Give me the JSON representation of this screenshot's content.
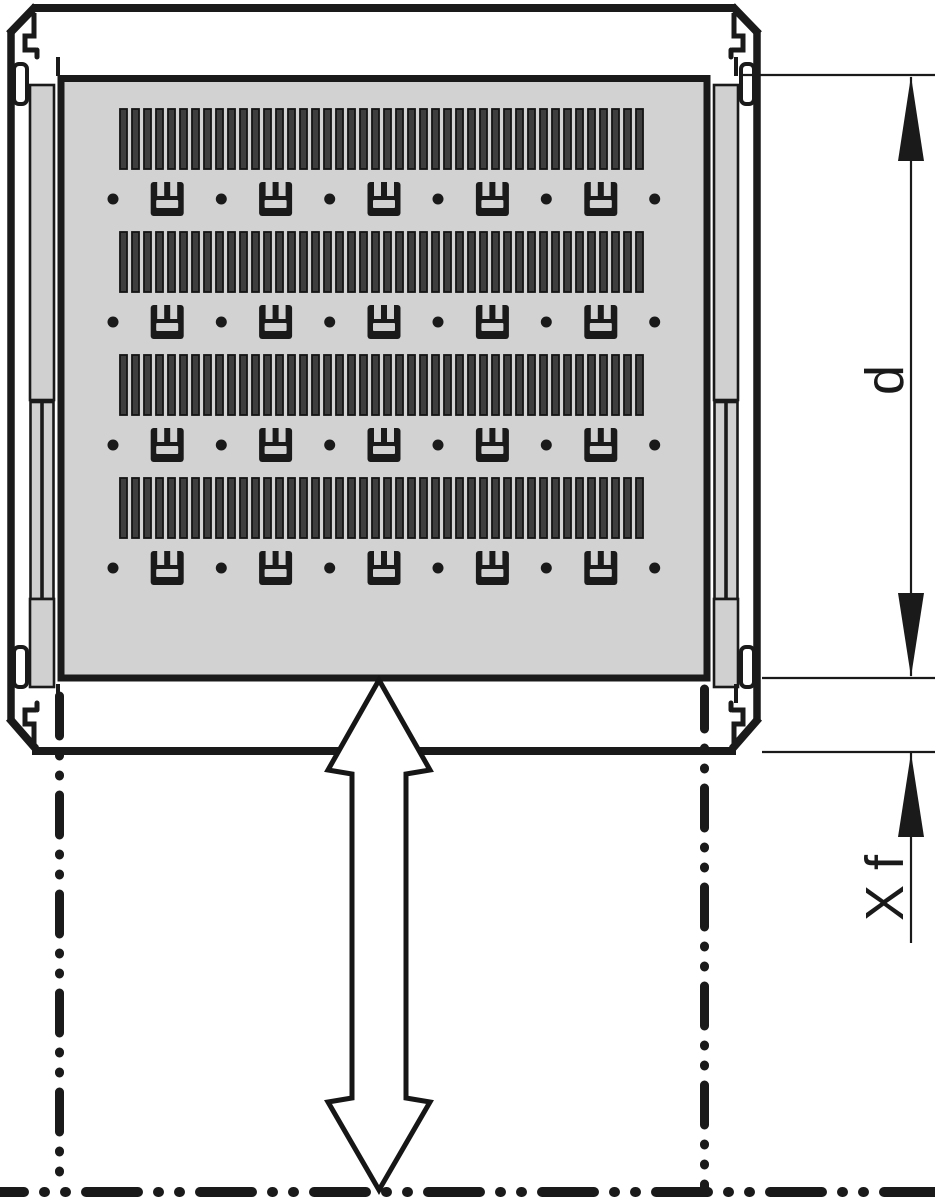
{
  "labels": {
    "d": "d",
    "xf": "X f"
  },
  "colors": {
    "line": "#1a1a1a",
    "panel": "#d2d2d2",
    "rail": "#d0d0d0",
    "slat_fill": "#3e3e3e",
    "slat_stroke": "#141414",
    "white": "#ffffff"
  },
  "diagram": {
    "slats": {
      "rows_y": [
        109,
        232,
        355,
        478
      ],
      "count": 44,
      "x_start": 120,
      "pitch": 12,
      "width": 7,
      "height": 60
    },
    "clips": {
      "rows_y": [
        182,
        305,
        428,
        551
      ],
      "centers_x": [
        167.2,
        275.6,
        384,
        492.4,
        600.8
      ],
      "dots_x": [
        113,
        221.3,
        329.7,
        438,
        546.3,
        654.7
      ],
      "width": 33,
      "height": 34,
      "dot_r": 5.5
    }
  }
}
